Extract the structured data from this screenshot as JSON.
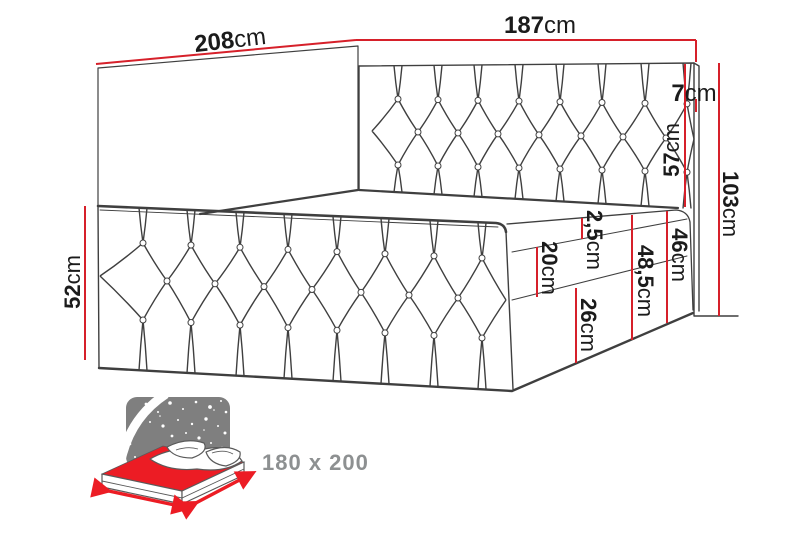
{
  "dimensions": {
    "length": {
      "value": "208",
      "unit": "cm"
    },
    "width": {
      "value": "187",
      "unit": "cm"
    },
    "headboard_edge": {
      "value": "7",
      "unit": "cm"
    },
    "headboard_height": {
      "value": "57",
      "unit": "cm"
    },
    "total_height": {
      "value": "103",
      "unit": "cm"
    },
    "side_height": {
      "value": "52",
      "unit": "cm"
    },
    "topper_height": {
      "value": "2,5",
      "unit": "cm"
    },
    "mattress_height": {
      "value": "20",
      "unit": "cm"
    },
    "base_height": {
      "value": "26",
      "unit": "cm"
    },
    "base_mattress_height": {
      "value": "46",
      "unit": "cm"
    },
    "sleep_surface_height": {
      "value": "48,5",
      "unit": "cm"
    }
  },
  "size_badge": {
    "label": "180 x 200"
  },
  "colors": {
    "dimension_red": "#d6202a",
    "line_dark": "#3f3f3f",
    "icon_gray": "#7f7f7f",
    "icon_red": "#ec1c24",
    "badge_text_gray": "#8d9091"
  }
}
